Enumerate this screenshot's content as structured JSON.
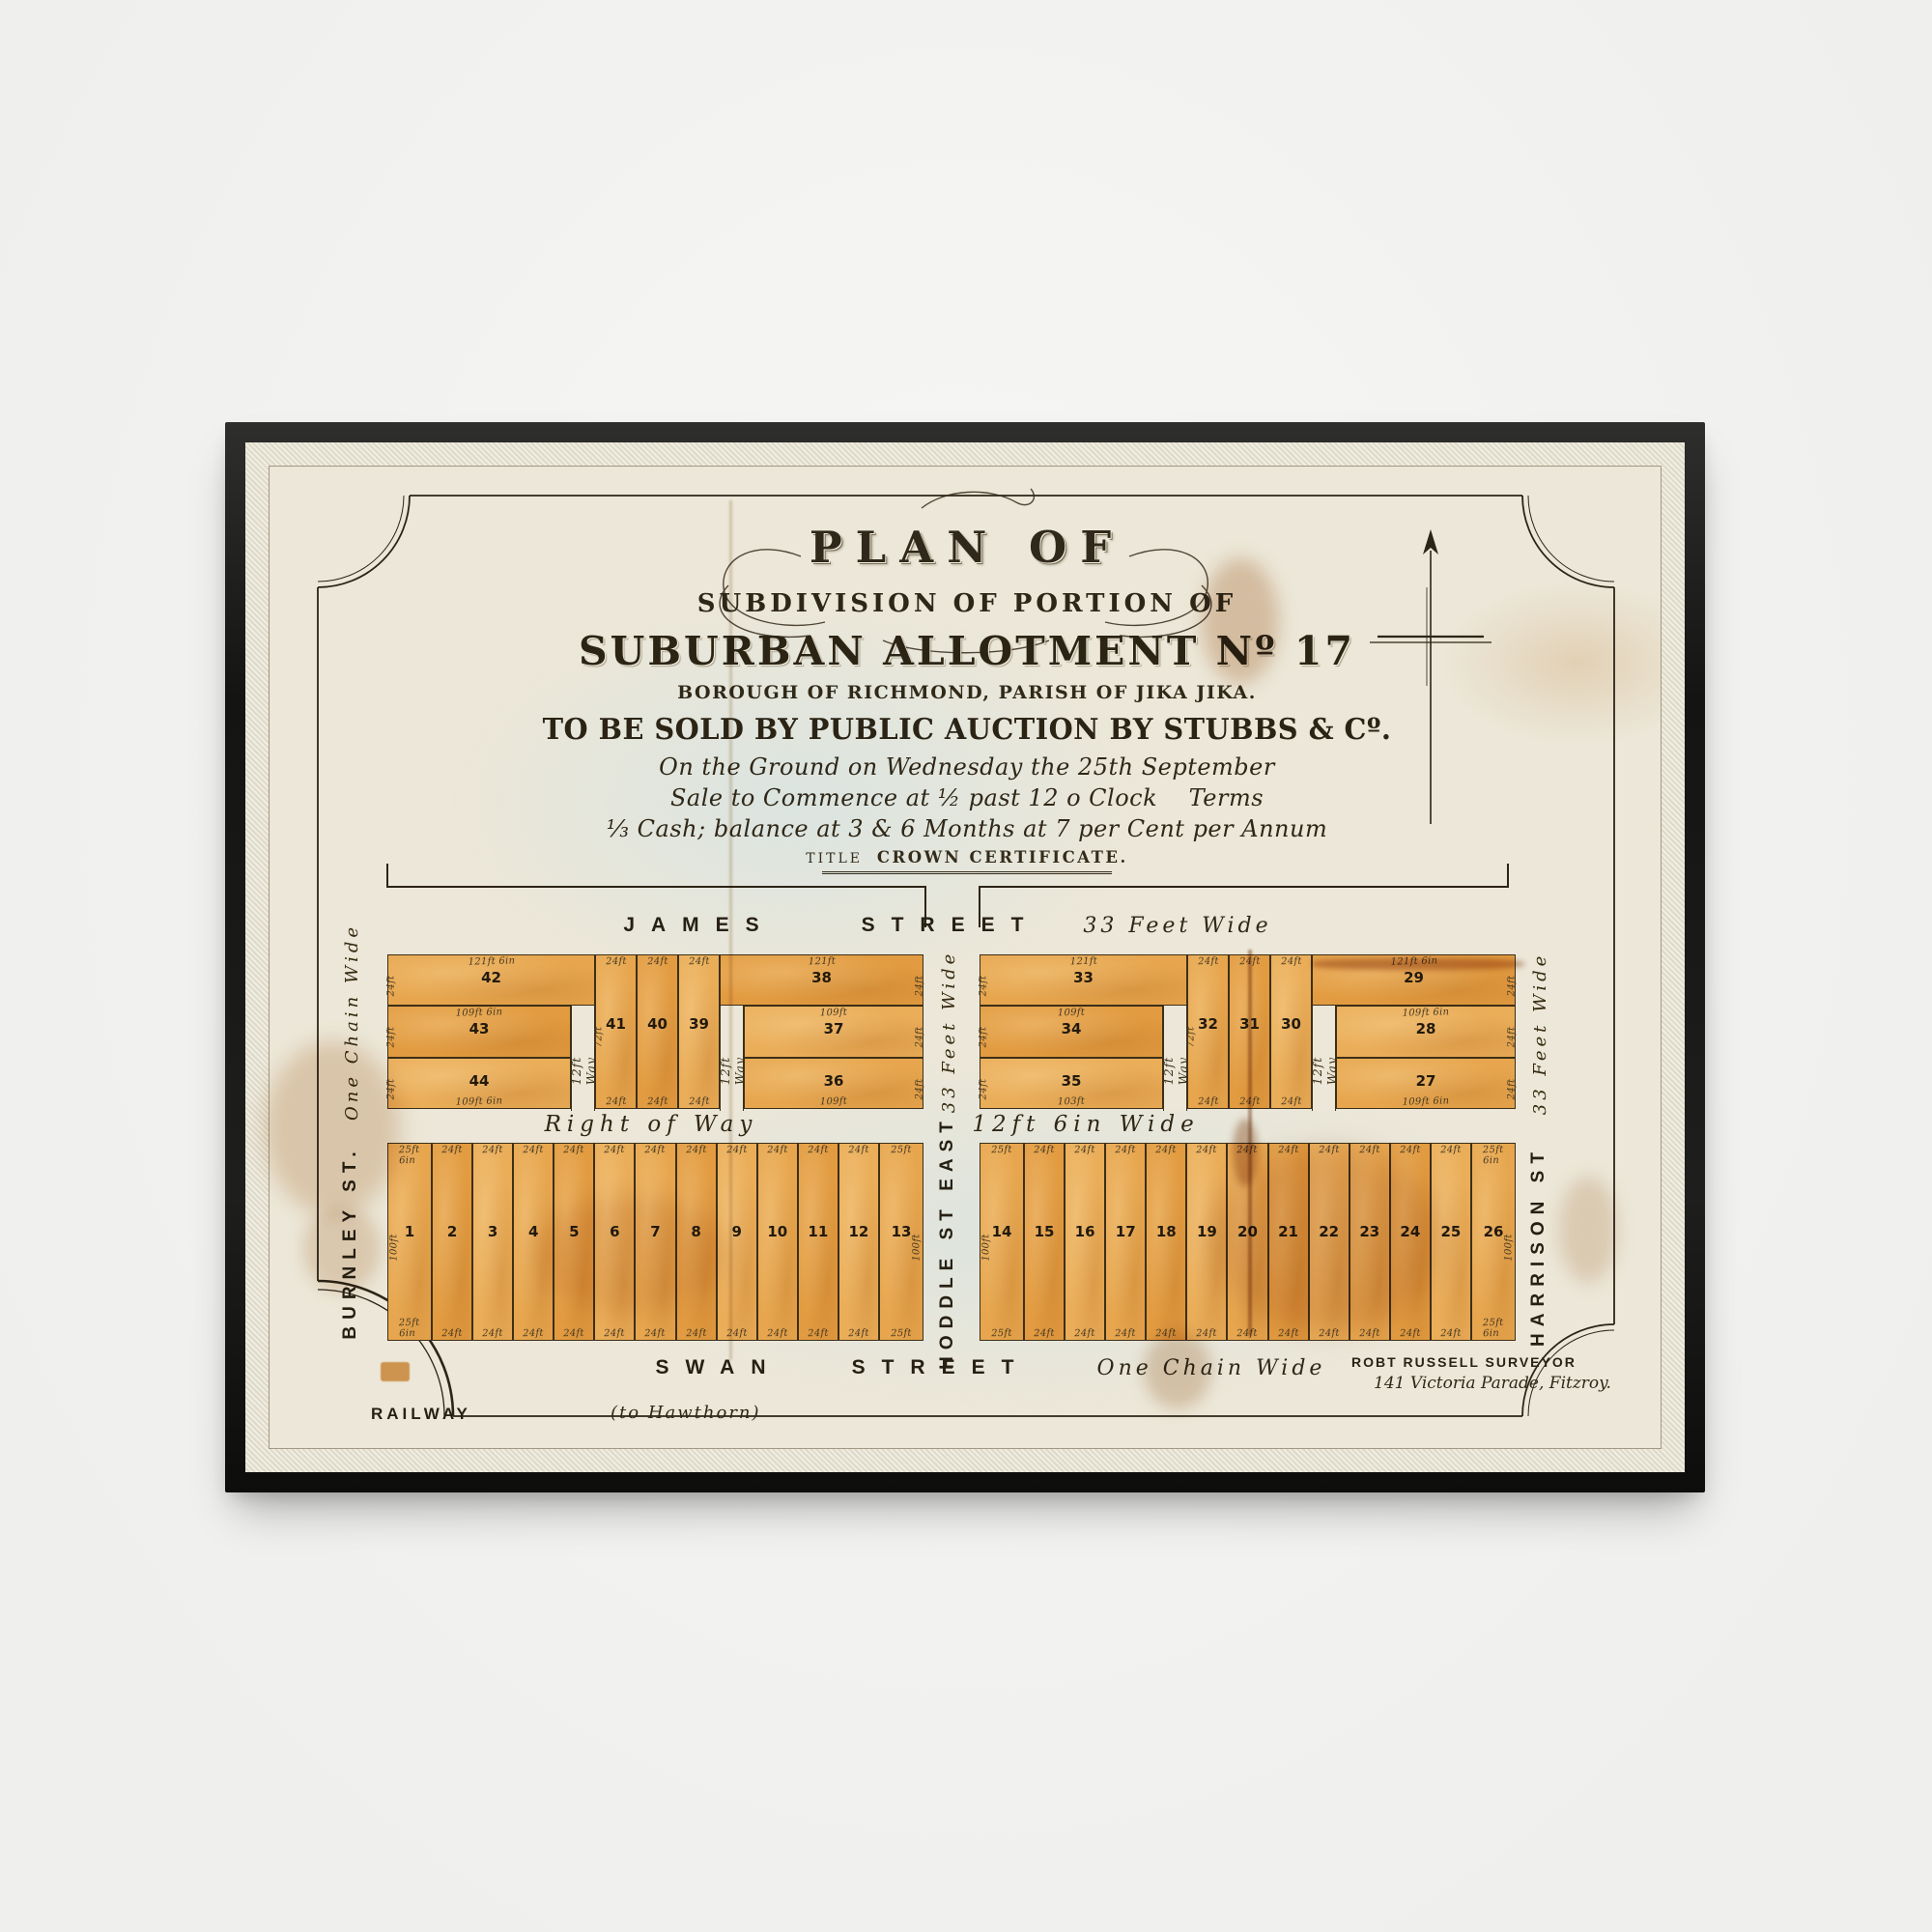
{
  "palette": {
    "wall": "#f5f5f3",
    "frame": "#1f1f1d",
    "paper": "#ece7d8",
    "lot_fill": "#e5a24a",
    "ink": "#2c2416"
  },
  "artwork": {
    "title_block": {
      "plan_of": "PLAN OF",
      "subdivision": "SUBDIVISION OF PORTION OF",
      "allotment": "SUBURBAN ALLOTMENT Nº 17",
      "borough": "BOROUGH OF RICHMOND, PARISH OF JIKA JIKA.",
      "auction": "TO BE SOLD BY PUBLIC AUCTION BY STUBBS & Cº.",
      "script1": "On the Ground on Wednesday the 25th September",
      "script2": "Sale to Commence at ½ past 12 o Clock    Terms",
      "script3": "⅓ Cash; balance at 3 & 6 Months at 7 per Cent per Annum",
      "title_prefix": "TITLE",
      "title_main": "CROWN CERTIFICATE."
    },
    "streets": {
      "james": {
        "word1": "JAMES",
        "word2": "STREET",
        "width_label": "33 Feet Wide"
      },
      "swan": {
        "word1": "SWAN",
        "word2": "STREET",
        "width_label": "One Chain Wide"
      },
      "burnley": {
        "name": "BURNLEY ST.",
        "width_label": "One Chain Wide"
      },
      "hoddle": {
        "name": "HODDLE ST EAST",
        "width_label": "33 Feet Wide"
      },
      "harrison": {
        "name": "HARRISON ST",
        "width_label": "33 Feet Wide"
      },
      "right_of_way": {
        "name": "Right of Way",
        "width_label": "12ft 6in Wide"
      }
    },
    "railway": {
      "name": "RAILWAY",
      "note": "(to Hawthorn)"
    },
    "surveyor": {
      "line1": "ROBT RUSSELL SURVEYOR",
      "line2": "141 Victoria Parade, Fitzroy."
    }
  },
  "blocks": {
    "top_west": {
      "wide_top_left": {
        "number": "42",
        "top_dim": "121ft 6in",
        "side_dim": "24ft"
      },
      "stack_left": [
        {
          "number": "43",
          "top_dim": "109ft 6in",
          "side_dim": "24ft"
        },
        {
          "number": "44",
          "bottom_dim": "109ft 6in",
          "side_dim": "24ft"
        }
      ],
      "way_left": "12ft Way",
      "verticals": [
        {
          "number": "41",
          "top_dim": "24ft",
          "bottom_dim": "24ft",
          "depth_dim": "72ft"
        },
        {
          "number": "40",
          "top_dim": "24ft",
          "bottom_dim": "24ft"
        },
        {
          "number": "39",
          "top_dim": "24ft",
          "bottom_dim": "24ft"
        }
      ],
      "way_right": "12ft Way",
      "wide_top_right": {
        "number": "38",
        "top_dim": "121ft",
        "side_dim": "24ft"
      },
      "stack_right": [
        {
          "number": "37",
          "top_dim": "109ft",
          "side_dim": "24ft"
        },
        {
          "number": "36",
          "bottom_dim": "109ft",
          "side_dim": "24ft"
        }
      ]
    },
    "top_east": {
      "wide_top_left": {
        "number": "33",
        "top_dim": "121ft",
        "side_dim": "24ft"
      },
      "stack_left": [
        {
          "number": "34",
          "top_dim": "109ft",
          "side_dim": "24ft"
        },
        {
          "number": "35",
          "bottom_dim": "103ft",
          "side_dim": "24ft"
        }
      ],
      "way_left": "12ft Way",
      "verticals": [
        {
          "number": "32",
          "top_dim": "24ft",
          "bottom_dim": "24ft",
          "depth_dim": "72ft"
        },
        {
          "number": "31",
          "top_dim": "24ft",
          "bottom_dim": "24ft"
        },
        {
          "number": "30",
          "top_dim": "24ft",
          "bottom_dim": "24ft"
        }
      ],
      "way_right": "12ft Way",
      "wide_top_right": {
        "number": "29",
        "top_dim": "121ft 6in",
        "side_dim": "24ft"
      },
      "stack_right": [
        {
          "number": "28",
          "top_dim": "109ft 6in",
          "side_dim": "24ft"
        },
        {
          "number": "27",
          "bottom_dim": "109ft 6in",
          "side_dim": "24ft"
        }
      ]
    },
    "bottom_west": {
      "depth_dim": "100ft",
      "lots": [
        {
          "number": "1",
          "top_dim": "25ft 6in",
          "bottom_dim": "25ft 6in"
        },
        {
          "number": "2",
          "top_dim": "24ft",
          "bottom_dim": "24ft"
        },
        {
          "number": "3",
          "top_dim": "24ft",
          "bottom_dim": "24ft"
        },
        {
          "number": "4",
          "top_dim": "24ft",
          "bottom_dim": "24ft"
        },
        {
          "number": "5",
          "top_dim": "24ft",
          "bottom_dim": "24ft"
        },
        {
          "number": "6",
          "top_dim": "24ft",
          "bottom_dim": "24ft"
        },
        {
          "number": "7",
          "top_dim": "24ft",
          "bottom_dim": "24ft"
        },
        {
          "number": "8",
          "top_dim": "24ft",
          "bottom_dim": "24ft"
        },
        {
          "number": "9",
          "top_dim": "24ft",
          "bottom_dim": "24ft"
        },
        {
          "number": "10",
          "top_dim": "24ft",
          "bottom_dim": "24ft"
        },
        {
          "number": "11",
          "top_dim": "24ft",
          "bottom_dim": "24ft"
        },
        {
          "number": "12",
          "top_dim": "24ft",
          "bottom_dim": "24ft"
        },
        {
          "number": "13",
          "top_dim": "25ft",
          "bottom_dim": "25ft"
        }
      ]
    },
    "bottom_east": {
      "depth_dim": "100ft",
      "lots": [
        {
          "number": "14",
          "top_dim": "25ft",
          "bottom_dim": "25ft"
        },
        {
          "number": "15",
          "top_dim": "24ft",
          "bottom_dim": "24ft"
        },
        {
          "number": "16",
          "top_dim": "24ft",
          "bottom_dim": "24ft"
        },
        {
          "number": "17",
          "top_dim": "24ft",
          "bottom_dim": "24ft"
        },
        {
          "number": "18",
          "top_dim": "24ft",
          "bottom_dim": "24ft"
        },
        {
          "number": "19",
          "top_dim": "24ft",
          "bottom_dim": "24ft"
        },
        {
          "number": "20",
          "top_dim": "24ft",
          "bottom_dim": "24ft"
        },
        {
          "number": "21",
          "top_dim": "24ft",
          "bottom_dim": "24ft"
        },
        {
          "number": "22",
          "top_dim": "24ft",
          "bottom_dim": "24ft"
        },
        {
          "number": "23",
          "top_dim": "24ft",
          "bottom_dim": "24ft"
        },
        {
          "number": "24",
          "top_dim": "24ft",
          "bottom_dim": "24ft"
        },
        {
          "number": "25",
          "top_dim": "24ft",
          "bottom_dim": "24ft"
        },
        {
          "number": "26",
          "top_dim": "25ft 6in",
          "bottom_dim": "25ft 6in"
        }
      ]
    }
  }
}
